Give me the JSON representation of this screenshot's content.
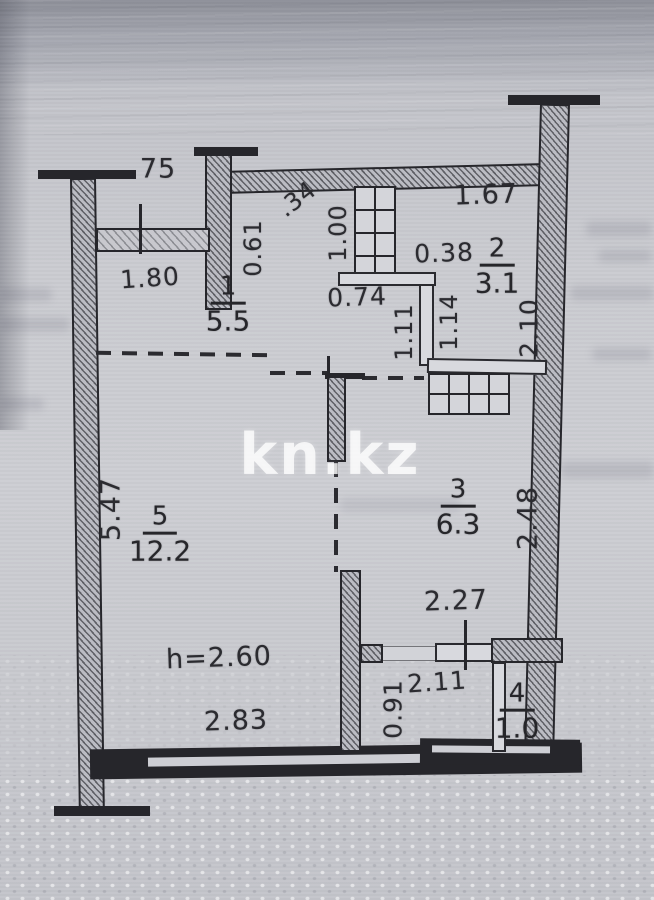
{
  "plan": {
    "watermark": "kn.kz",
    "ceiling_height_label": "h=2.60",
    "rooms": {
      "r1": {
        "number": "1",
        "area": "5.5"
      },
      "r2": {
        "number": "2",
        "area": "3.1"
      },
      "r3": {
        "number": "3",
        "area": "6.3"
      },
      "r4": {
        "number": "4",
        "area": "1.0"
      },
      "r5": {
        "number": "5",
        "area": "12.2"
      }
    },
    "dims": {
      "balcony_width": "75",
      "balcony_length": "1.80",
      "hall_wall": "0.61",
      "diag": ".34",
      "duct": "1.00",
      "bath_width": "1.67",
      "bath_offset": "0.38",
      "bath_right": "2.10",
      "lobby_door": "0.74",
      "lobby_w1": "1.11",
      "lobby_w2": "1.14",
      "living_height": "5.47",
      "kitchen_right": "2.48",
      "kitchen_width": "2.27",
      "living_width": "2.83",
      "corridor_width": "0.91",
      "corridor_length": "2.11"
    },
    "colors": {
      "paper": "#c9cacf",
      "ink": "#2a2a2e",
      "watermark": "#ffffff"
    }
  }
}
